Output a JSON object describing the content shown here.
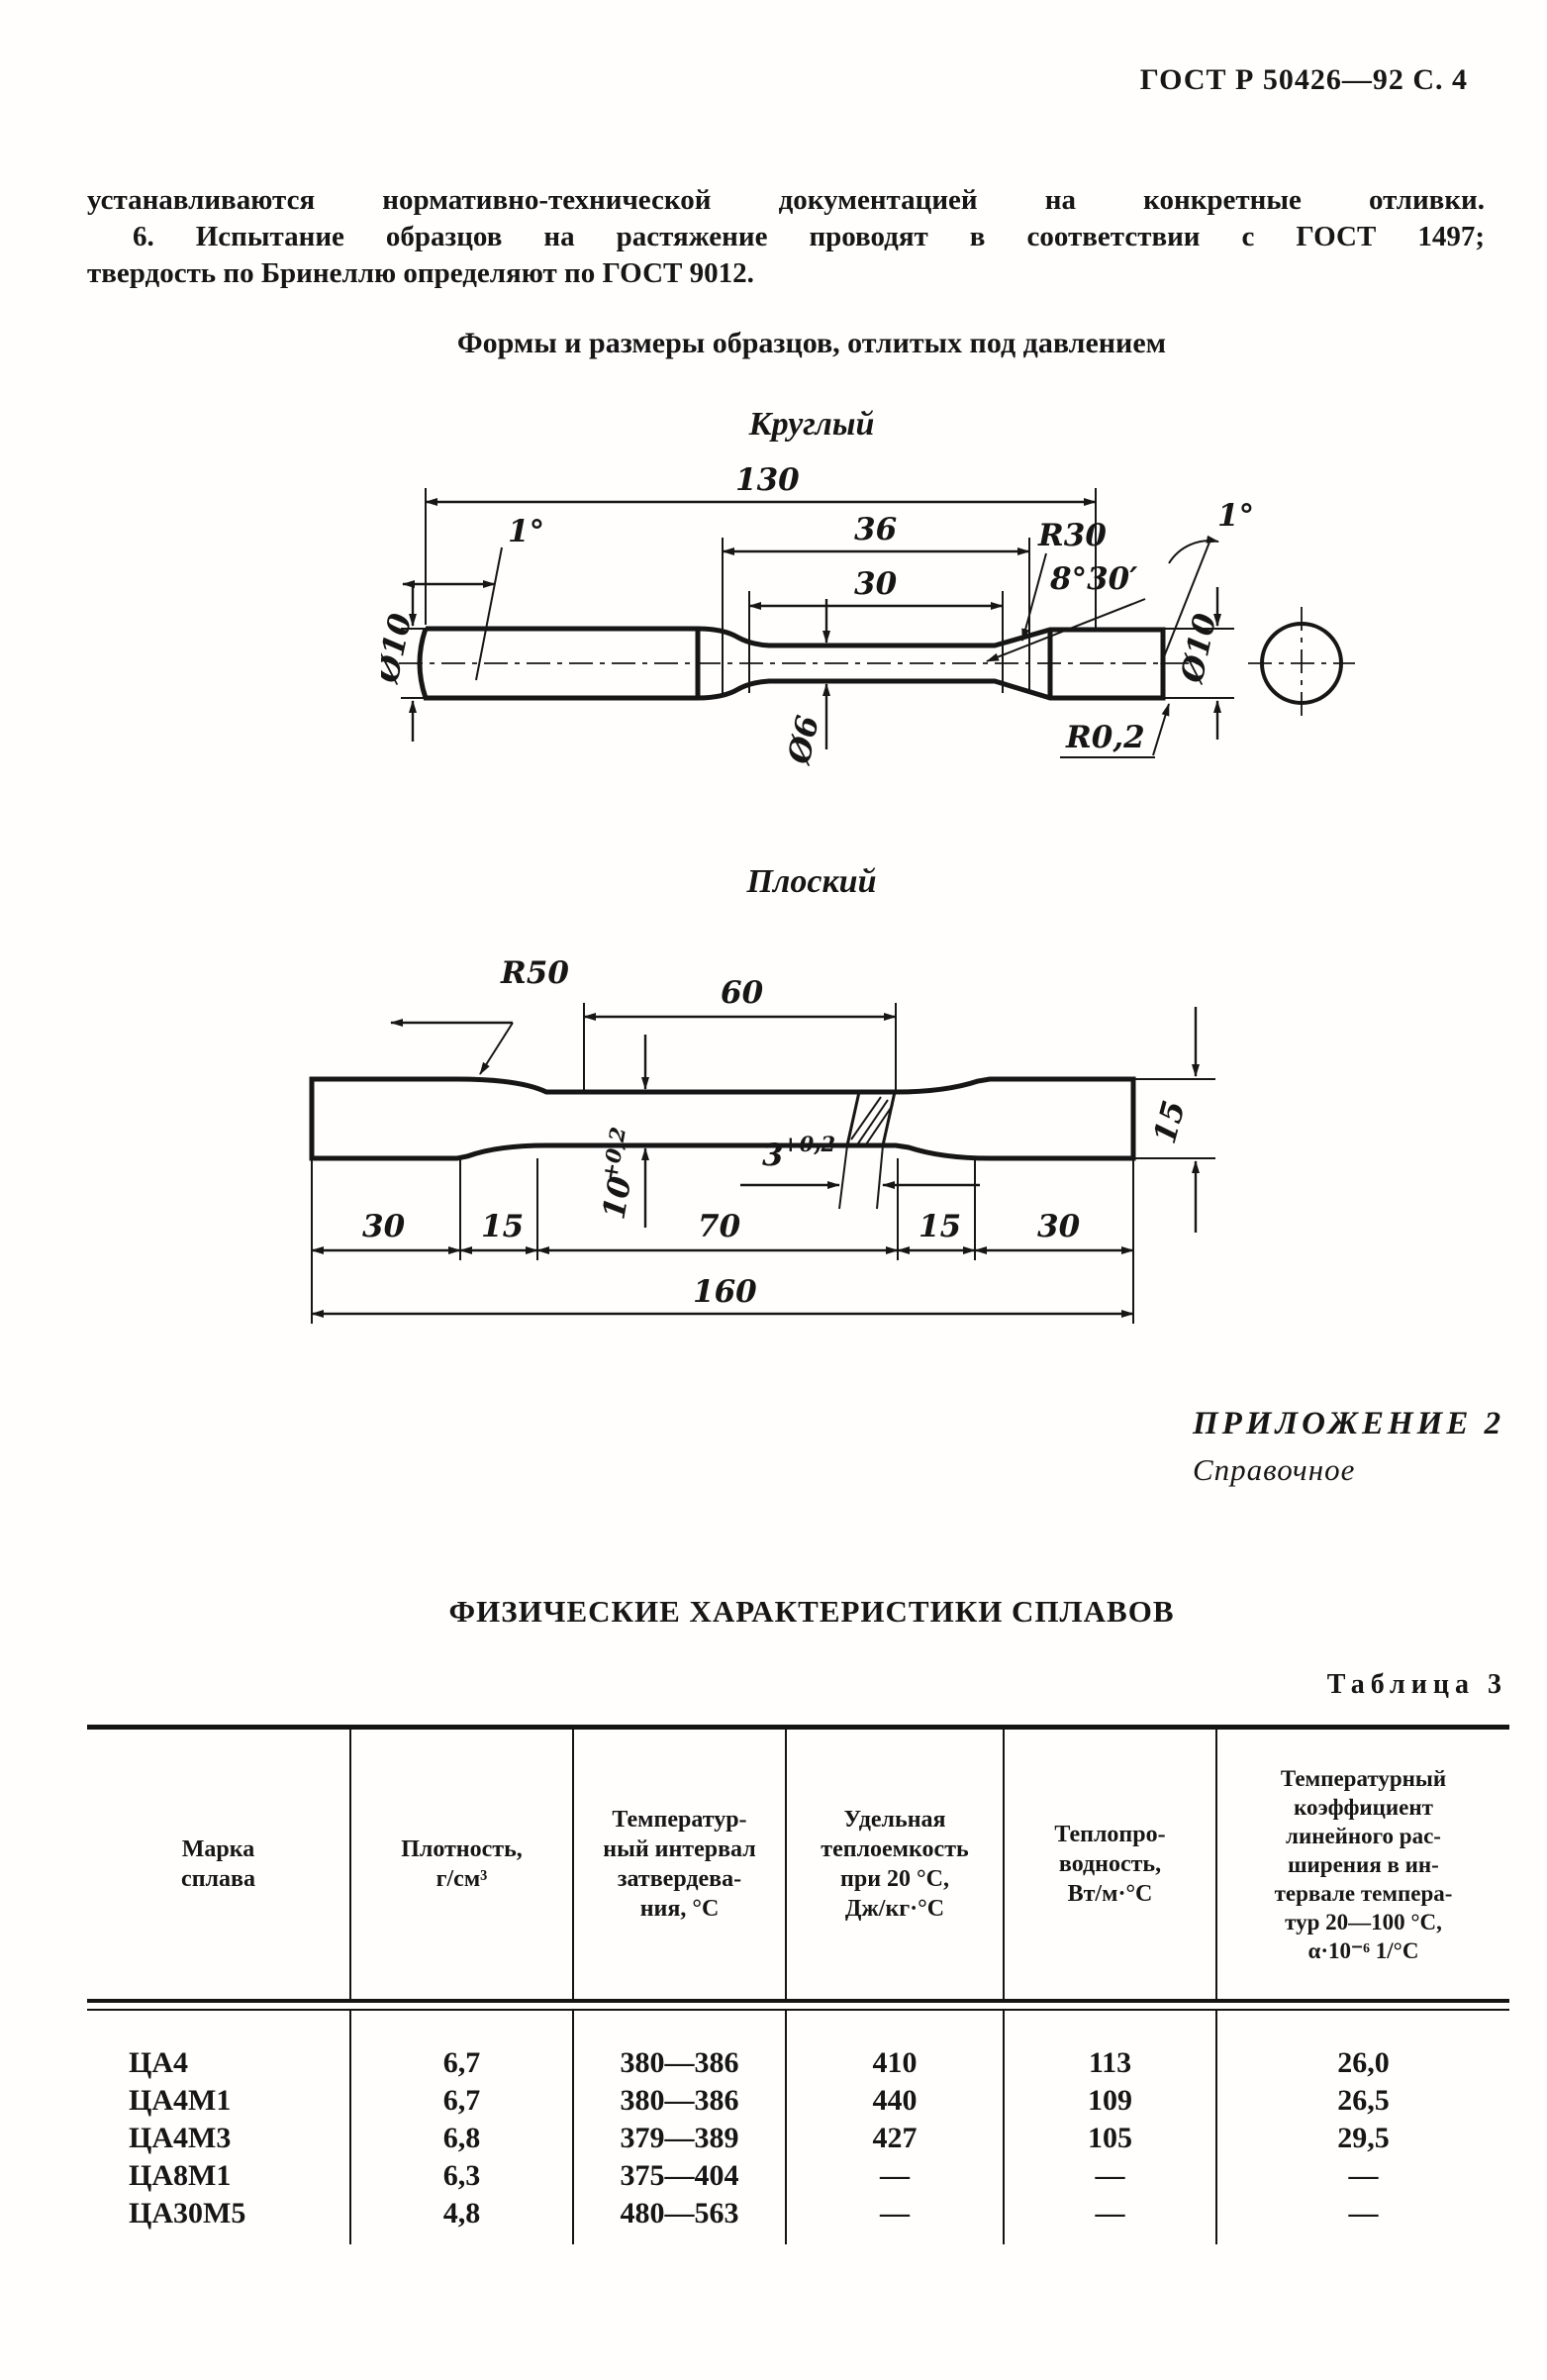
{
  "header": {
    "text": "ГОСТ Р 50426—92 С. 4"
  },
  "intro": {
    "line1": "устанавливаются нормативно-технической документацией на конкретные отливки.",
    "line2": "6. Испытание образцов на растяжение проводят в соответствии с ГОСТ 1497;",
    "line3": "твердость по Бринеллю определяют по ГОСТ 9012."
  },
  "forms": {
    "title": "Формы и размеры образцов, отлитых под давлением",
    "round": {
      "caption": "Круглый",
      "dims": {
        "length": "130",
        "gauge36": "36",
        "gauge30": "30",
        "r30": "R30",
        "angle_left": "1°",
        "angle_right": "1°",
        "taper": "8°30′",
        "dia_left": "Ø10",
        "dia_mid": "Ø6",
        "dia_right": "Ø10",
        "r02": "R0,2"
      }
    },
    "flat": {
      "caption": "Плоский",
      "dims": {
        "r50": "R50",
        "gauge": "60",
        "width15": "15",
        "w_base": "10",
        "w_tol": "+0,2",
        "t_base": "3",
        "t_tol": "+0,2",
        "seg1": "30",
        "seg2": "15",
        "seg3": "70",
        "seg4": "15",
        "seg5": "30",
        "total": "160"
      }
    }
  },
  "appendix": {
    "title": "ПРИЛОЖЕНИЕ 2",
    "subtitle": "Справочное"
  },
  "phys": {
    "title": "ФИЗИЧЕСКИЕ ХАРАКТЕРИСТИКИ СПЛАВОВ",
    "table_label": "Таблица 3",
    "table": {
      "headers": [
        "Марка\nсплава",
        "Плотность,\nг/см³",
        "Температур-\nный интервал\nзатвердева-\nния, °С",
        "Удельная\nтеплоемкость\nпри 20 °С,\nДж/кг·°С",
        "Теплопро-\nводность,\nВт/м·°С",
        "Температурный\nкоэффициент\nлинейного рас-\nширения в ин-\nтервале темпера-\nтур 20—100 °С,\nα·10⁻⁶ 1/°С"
      ],
      "rows": [
        {
          "brand": "ЦА4",
          "density": "6,7",
          "interval": "380—386",
          "heat": "410",
          "conductivity": "113",
          "expansion": "26,0"
        },
        {
          "brand": "ЦА4М1",
          "density": "6,7",
          "interval": "380—386",
          "heat": "440",
          "conductivity": "109",
          "expansion": "26,5"
        },
        {
          "brand": "ЦА4М3",
          "density": "6,8",
          "interval": "379—389",
          "heat": "427",
          "conductivity": "105",
          "expansion": "29,5"
        },
        {
          "brand": "ЦА8М1",
          "density": "6,3",
          "interval": "375—404",
          "heat": "—",
          "conductivity": "—",
          "expansion": "—"
        },
        {
          "brand": "ЦА30М5",
          "density": "4,8",
          "interval": "480—563",
          "heat": "—",
          "conductivity": "—",
          "expansion": "—"
        }
      ]
    }
  }
}
